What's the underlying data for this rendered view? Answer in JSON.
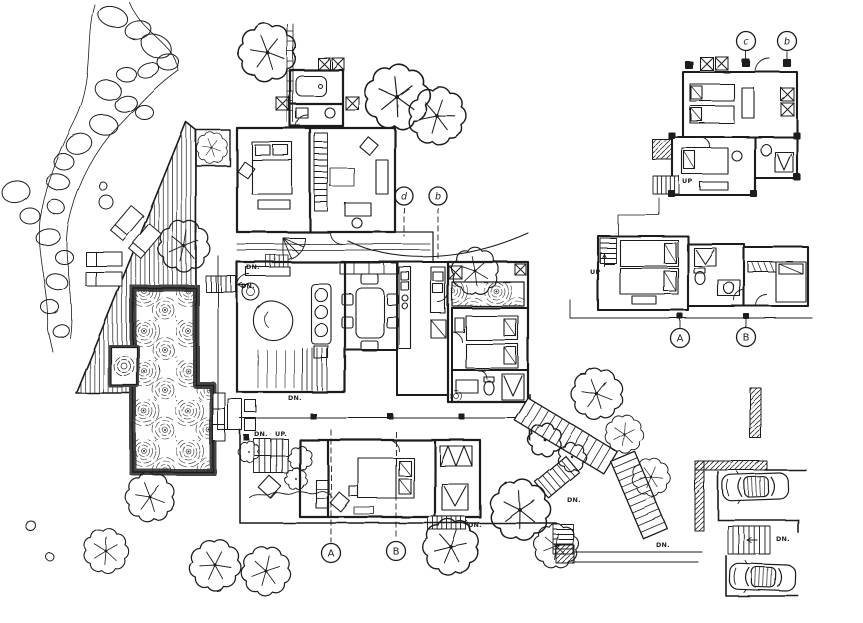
{
  "drawing": {
    "kind": "architectural floor plan",
    "style": "hand-drawn ink sketch",
    "paper_color": "#ffffff",
    "ink_color": "#1d1d1d"
  },
  "grid_markers": [
    {
      "id": "marker-d-main",
      "label": "d"
    },
    {
      "id": "marker-b-main",
      "label": "b"
    },
    {
      "id": "marker-c-upper",
      "label": "c"
    },
    {
      "id": "marker-b-upper",
      "label": "b"
    },
    {
      "id": "marker-A-main",
      "label": "A"
    },
    {
      "id": "marker-B-main",
      "label": "B"
    },
    {
      "id": "marker-A-wing",
      "label": "A"
    },
    {
      "id": "marker-B-wing",
      "label": "B"
    }
  ],
  "stair_labels": [
    {
      "id": "dn-upper-porch",
      "text": "DN."
    },
    {
      "id": "dn-pool-stair",
      "text": "DN."
    },
    {
      "id": "dn-living-steps",
      "text": "DN."
    },
    {
      "id": "dn-terrace-stair",
      "text": "DN."
    },
    {
      "id": "up-terrace-stair",
      "text": "UP."
    },
    {
      "id": "dn-bedroom-east",
      "text": "DN."
    },
    {
      "id": "dn-garden-branch",
      "text": "DN."
    },
    {
      "id": "dn-lower-steps",
      "text": "DN."
    },
    {
      "id": "dn-parking-steps",
      "text": "DN."
    },
    {
      "id": "up-wing-stair",
      "text": "UP"
    },
    {
      "id": "up-upper-stair",
      "text": "UP"
    }
  ]
}
